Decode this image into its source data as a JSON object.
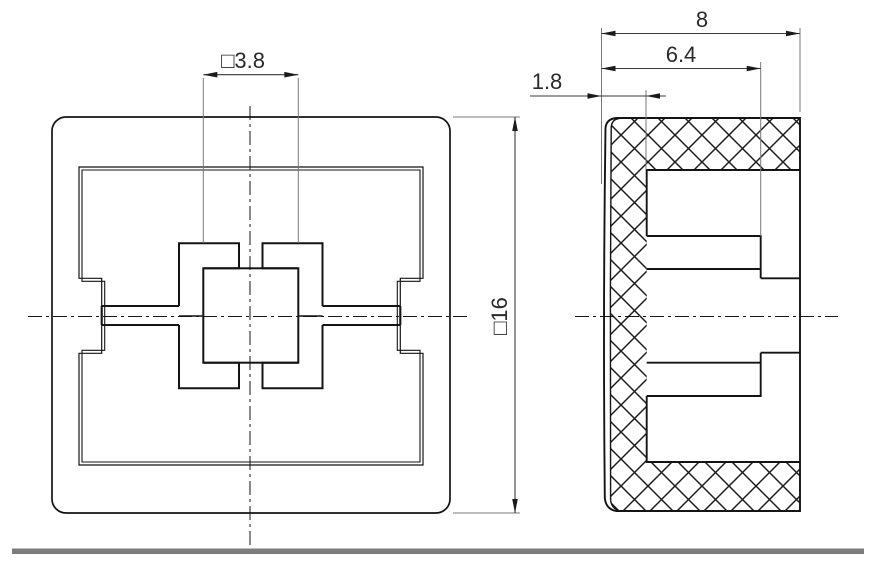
{
  "drawing": {
    "title": "switch-cap-two-view-technical-drawing",
    "views": {
      "front": {
        "name": "front view (square cap, 16 mm)"
      },
      "side": {
        "name": "side section view (hatched)"
      }
    },
    "dimensions": {
      "square_hole": "□3.8",
      "outer_square": "□16",
      "overall_depth": "8",
      "boss_depth": "6.4",
      "wall_thickness": "1.8"
    },
    "colors": {
      "object_line": "#141414",
      "dim_line": "#3a3a3a",
      "extension_line": "#787878",
      "divider_bar": "#7d7d7d",
      "background": "#ffffff"
    },
    "hatch": {
      "style": "crosshatch 45deg",
      "spacing_px": 27
    }
  }
}
